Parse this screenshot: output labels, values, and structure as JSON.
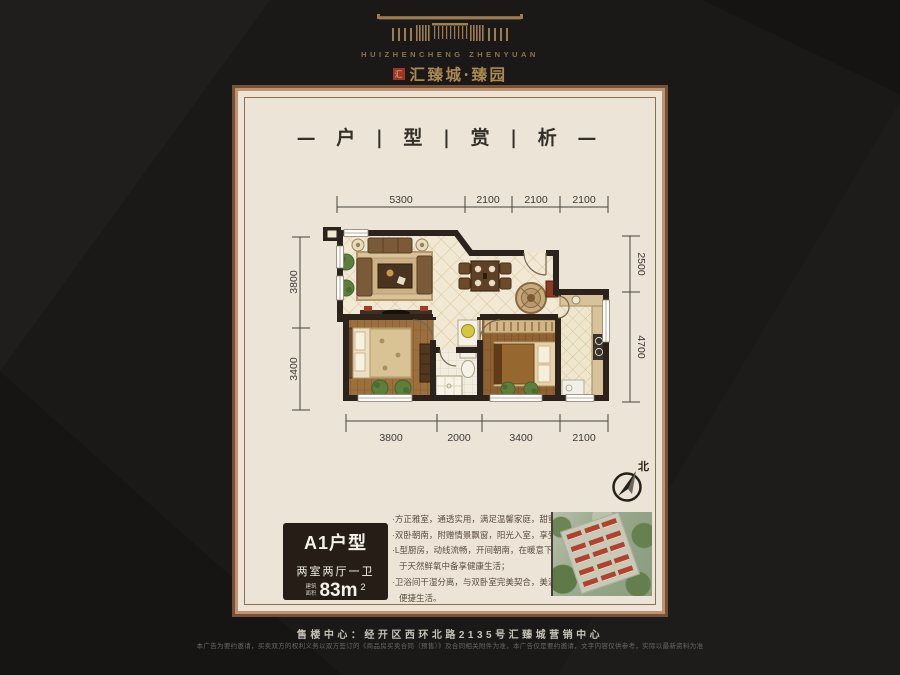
{
  "brand": {
    "logo_icon": "gate-emblem",
    "name_en": "HUIZHENCHENG ZHENYUAN",
    "seal_char": "汇",
    "name_cn": "汇臻城·臻园"
  },
  "title": {
    "text": "— 户 | 型 | 赏 | 析 —"
  },
  "floor_plan": {
    "dimensions": {
      "top": [
        "5300",
        "2100",
        "2100",
        "2100"
      ],
      "bottom": [
        "3800",
        "2000",
        "3400",
        "2100"
      ],
      "left": [
        "3800",
        "3400"
      ],
      "right": [
        "2500",
        "4700"
      ]
    },
    "compass": "北"
  },
  "unit": {
    "name": "A1户型",
    "layout": "两室两厅一卫",
    "area_label_top": "建筑",
    "area_label_bottom": "面积",
    "area_value": "83m",
    "area_sup": "2"
  },
  "features": [
    "·方正雅室，通透实用，满足温馨家庭，甜蜜二人世界；",
    "·双卧朝南，附赠情景飘窗，阳光入室，享受自然健康；",
    "·L型厨房，动线流畅，开间朝南，在暖意下品味美食，",
    "于天然鲜氧中备享健康生活；",
    "·卫浴间干湿分离，与双卧室完美契合，美满中更享",
    "便捷生活。"
  ],
  "footer": {
    "sales_center": "售楼中心：经开区西环北路2135号汇臻城营销中心",
    "disclaimer": "本广告为要约邀请，买卖双方的权利义务以双方签订的《商品房买卖合同（预售）》及合同相关附件为准，本广告仅是要约邀请，文字内容仅供参考，实际以最新资料为准"
  },
  "colors": {
    "background": "#1a1918",
    "card": "#ece4d6",
    "gold": "#9c7c50",
    "wall": "#2b231c",
    "seal_red": "#9e3426"
  }
}
